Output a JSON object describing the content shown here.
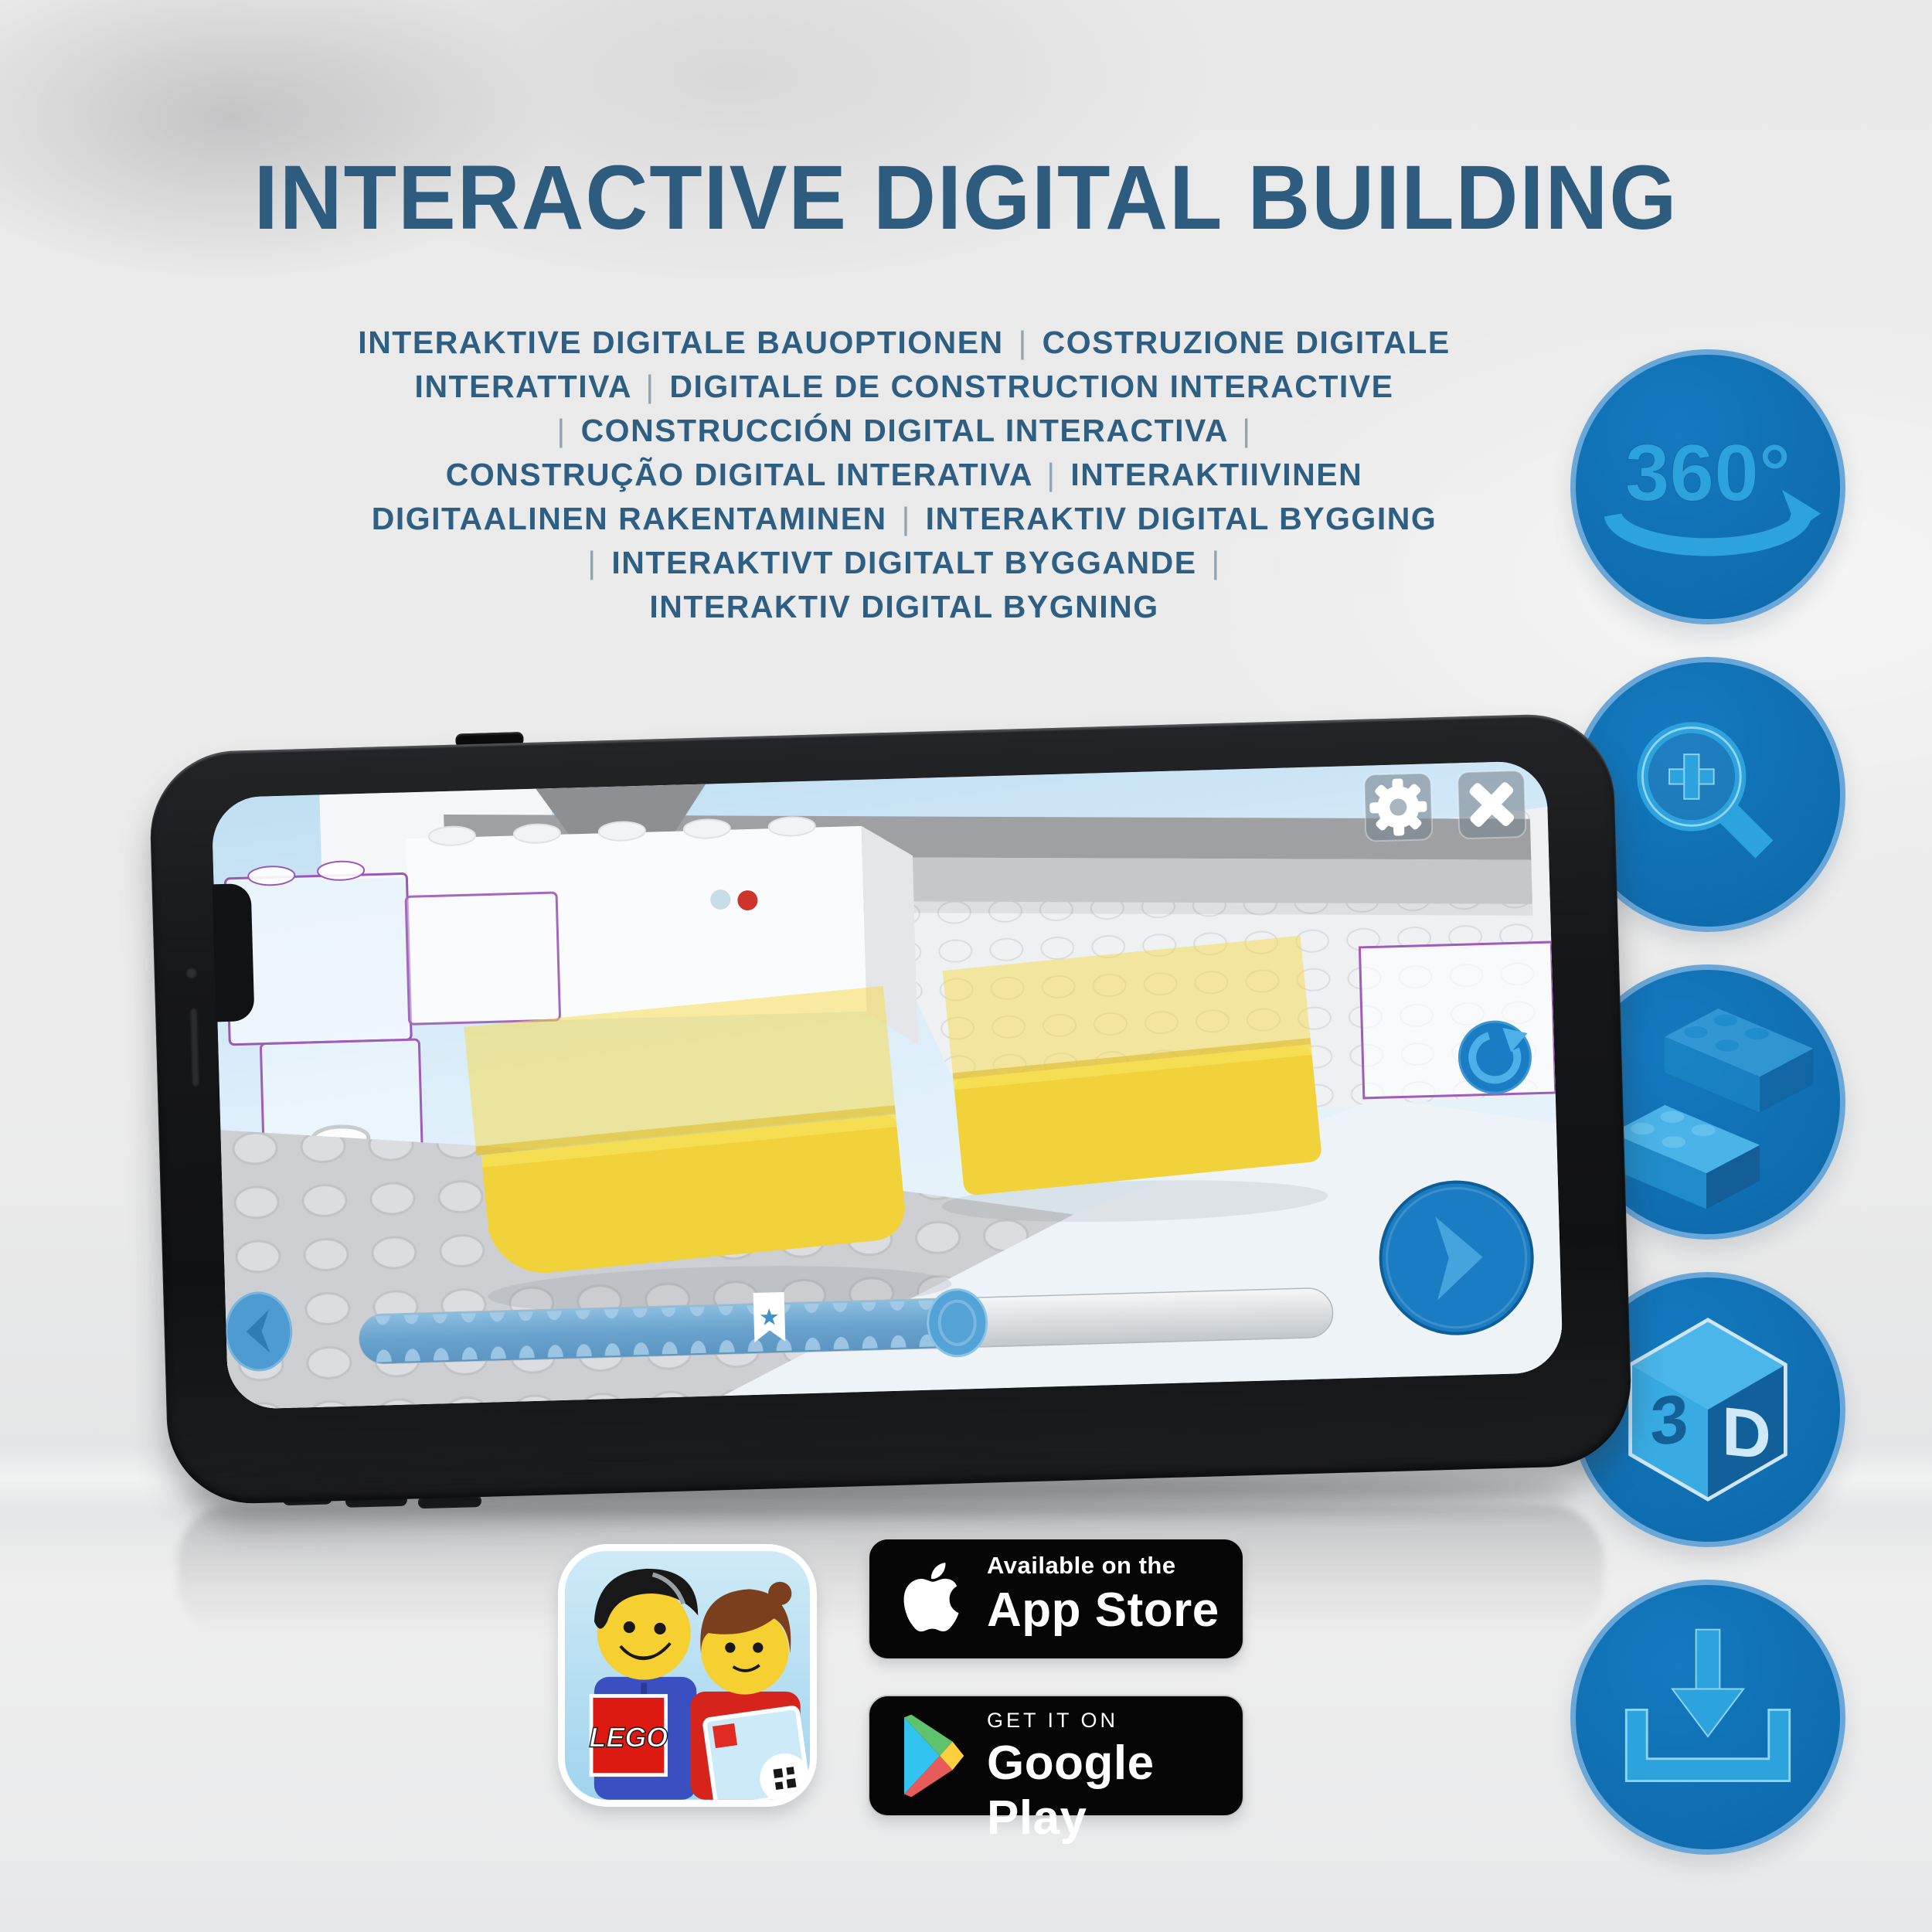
{
  "header": {
    "title": "INTERACTIVE DIGITAL BUILDING"
  },
  "subtitle": {
    "lines": [
      "INTERAKTIVE DIGITALE BAUOPTIONEN | COSTRUZIONE DIGITALE",
      "INTERATTIVA | DIGITALE DE CONSTRUCTION INTERACTIVE",
      "| CONSTRUCCIÓN DIGITAL INTERACTIVA |",
      "CONSTRUÇÃO DIGITAL INTERATIVA | INTERAKTIIVINEN",
      "DIGITAALINEN RAKENTAMINEN | INTERAKTIV DIGITAL BYGGING",
      "| INTERAKTIVT DIGITALT BYGGANDE |",
      "INTERAKTIV DIGITAL BYGNING"
    ]
  },
  "features": [
    {
      "id": "360-rotation",
      "label": "360°"
    },
    {
      "id": "zoom-in",
      "label": ""
    },
    {
      "id": "brick-building",
      "label": ""
    },
    {
      "id": "3d-view",
      "left": "3",
      "right": "D"
    },
    {
      "id": "download",
      "label": ""
    }
  ],
  "store_badges": {
    "app_store": {
      "tagline": "Available on the",
      "store": "App Store"
    },
    "google_play": {
      "tagline": "GET IT ON",
      "store": "Google Play"
    }
  },
  "app_icon": {
    "brand": "LEGO"
  },
  "colors": {
    "title_blue": "#2d5c7e",
    "circle_fill": "#1173b9",
    "circle_ring": "#69a7d8",
    "glyph_blue": "#2da3dd",
    "lego_yellow": "#f2d23a",
    "outline_purple": "#9b57b6",
    "lego_red": "#d6180b",
    "badge_black": "#050505"
  }
}
